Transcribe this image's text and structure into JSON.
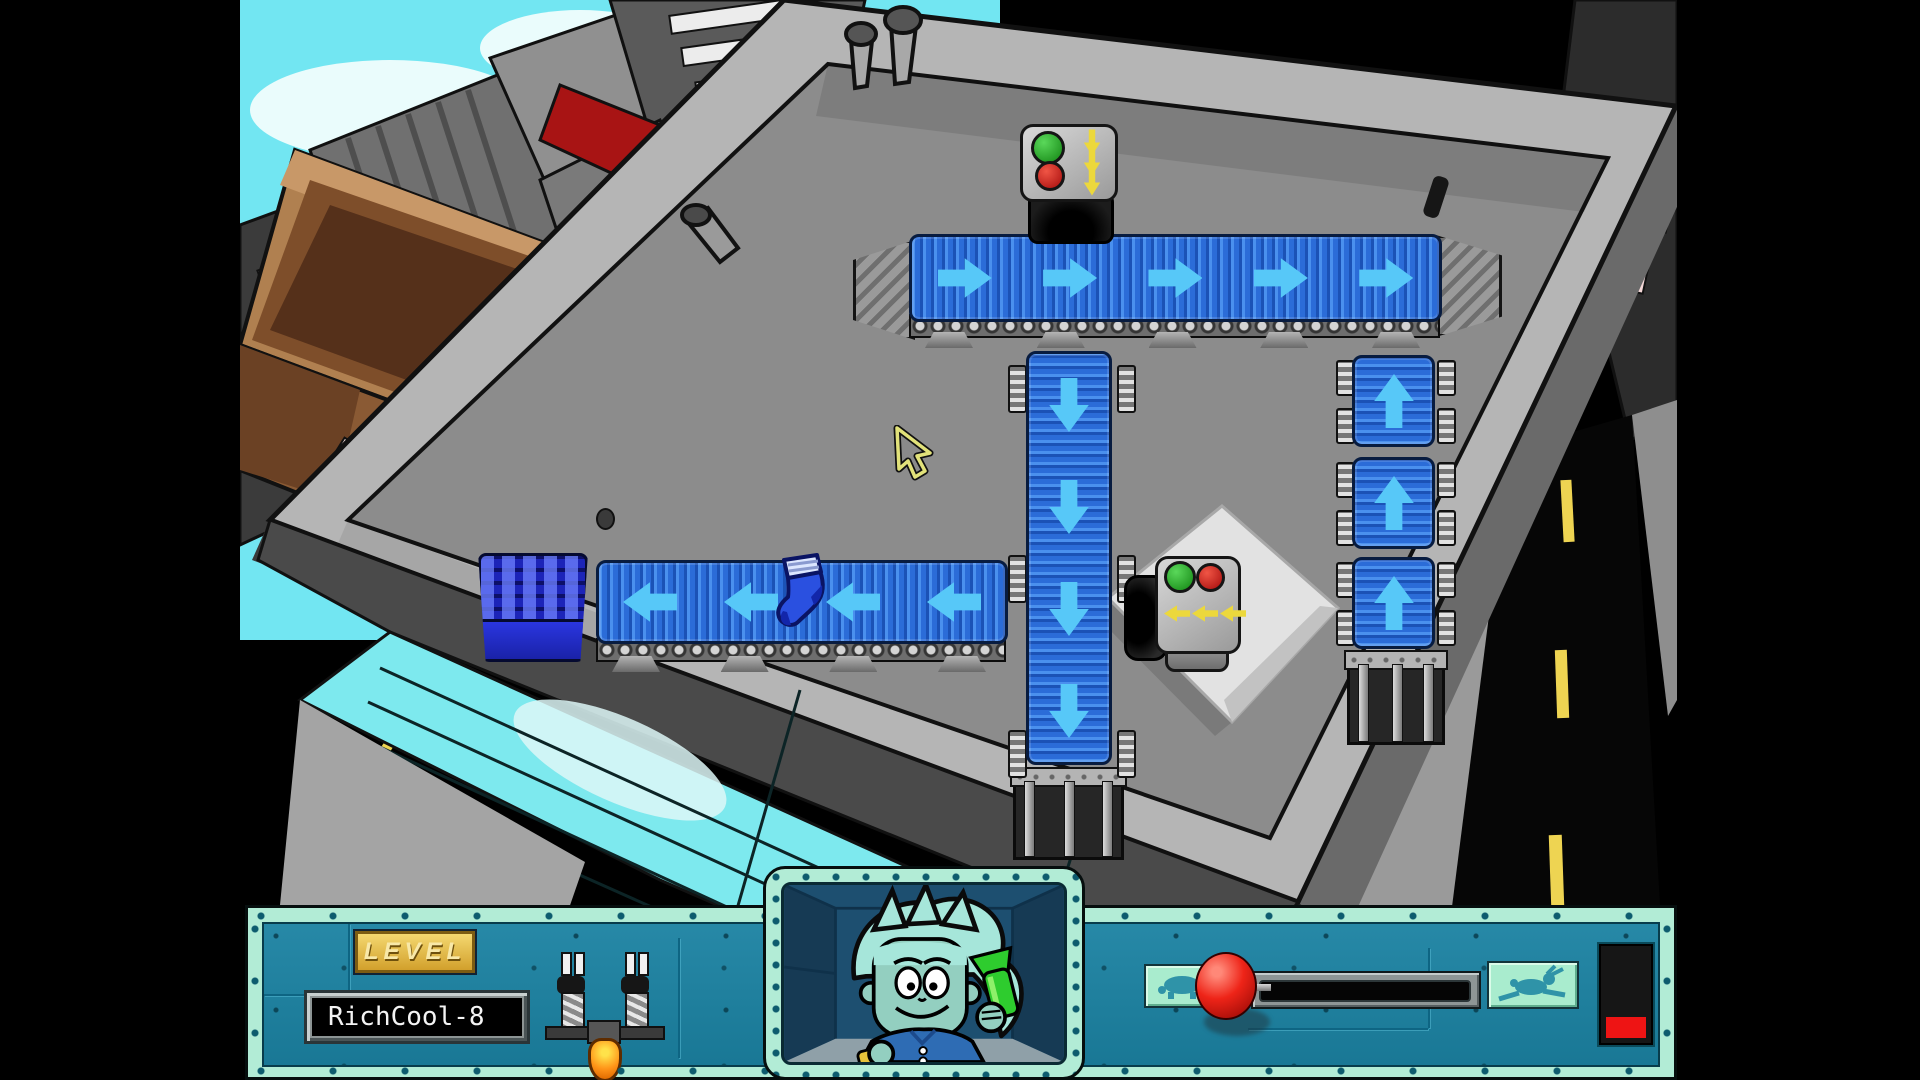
{
  "hud": {
    "level_plaque": "LEVEL",
    "level_name": "RichCool-8",
    "speed_control": {
      "slow_icon": "turtle",
      "fast_icon": "rabbit",
      "knob": "red-ball",
      "knob_position": "slow-end"
    },
    "progress_meter": {
      "fill_percent": 24,
      "fill_color": "#ee1414"
    },
    "launcher_tool": "sock-launcher",
    "portrait": "pajama-sam"
  },
  "board": {
    "conveyors": [
      {
        "id": "top-conveyor",
        "direction": "right",
        "arrow_count": 5
      },
      {
        "id": "center-vertical-conveyor",
        "direction": "down",
        "arrow_count": 4
      },
      {
        "id": "left-conveyor",
        "direction": "left",
        "arrow_count": 4
      },
      {
        "id": "right-column-top",
        "direction": "up",
        "arrow_count": 1
      },
      {
        "id": "right-column-middle",
        "direction": "up",
        "arrow_count": 1
      },
      {
        "id": "right-column-bottom",
        "direction": "up",
        "arrow_count": 1
      }
    ],
    "machines": [
      {
        "id": "sock-dispenser",
        "lights": [
          "green",
          "red"
        ],
        "arrow_direction": "down",
        "arrow_count": 3
      },
      {
        "id": "sock-redirector",
        "lights": [
          "green",
          "red"
        ],
        "arrow_direction": "left",
        "arrow_count": 3
      }
    ],
    "items": [
      {
        "id": "sock",
        "color": "blue"
      },
      {
        "id": "basket",
        "color": "blue"
      }
    ],
    "cursor": "yellow-arrow"
  },
  "colors": {
    "belt_blue": "#2b6cd8",
    "arrow_cyan": "#57c8f8",
    "panel_teal": "#1b82a2",
    "frame_mint": "#b2ecd6",
    "plaque_gold": "#e8c23c",
    "knob_red": "#e01010",
    "meter_red": "#ee1414",
    "light_green": "#1fa51f",
    "light_red": "#cc1414",
    "machine_arrow_yellow": "#ecd83c",
    "sky_cyan": "#72e6f2"
  }
}
